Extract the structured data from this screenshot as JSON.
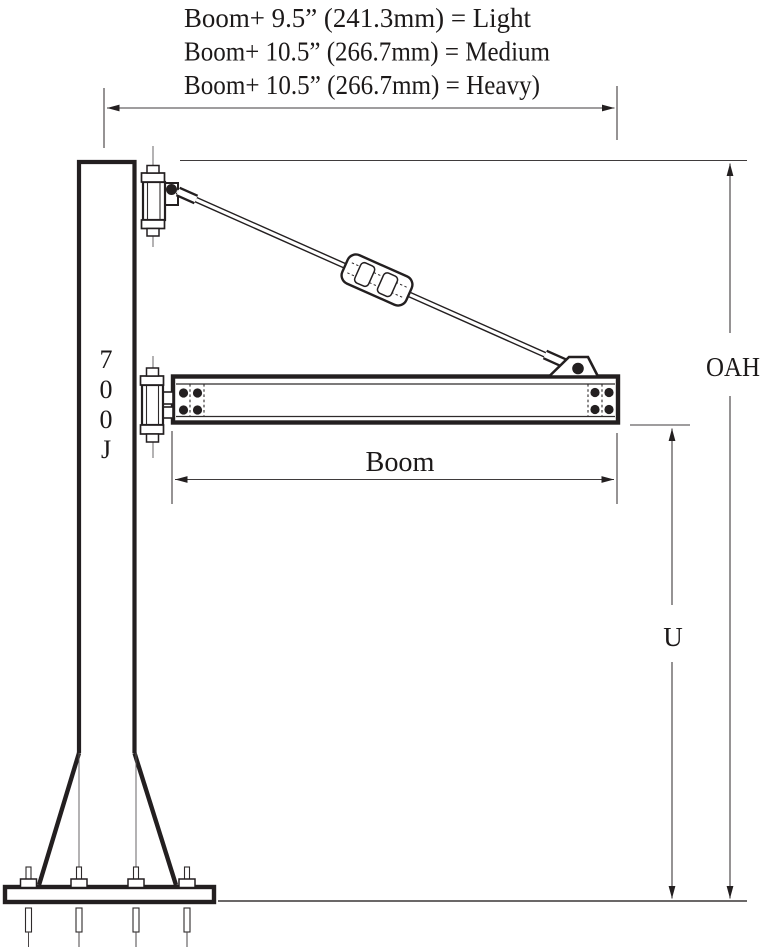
{
  "diagram": {
    "type": "technical-drawing",
    "subject": "Jib crane dimensional diagram",
    "annotations": {
      "line_light": "Boom+ 9.5” (241.3mm) = Light",
      "line_medium": "Boom+ 10.5” (266.7mm) = Medium",
      "line_heavy": "Boom+ 10.5” (266.7mm) = Heavy)"
    },
    "column": {
      "label": "700J",
      "label_chars": [
        "7",
        "0",
        "0",
        "J"
      ]
    },
    "dimensions": {
      "boom_label": "Boom",
      "oah_label": "OAH",
      "u_label": "U"
    },
    "colors": {
      "line": "#231f20",
      "background": "#ffffff"
    }
  }
}
